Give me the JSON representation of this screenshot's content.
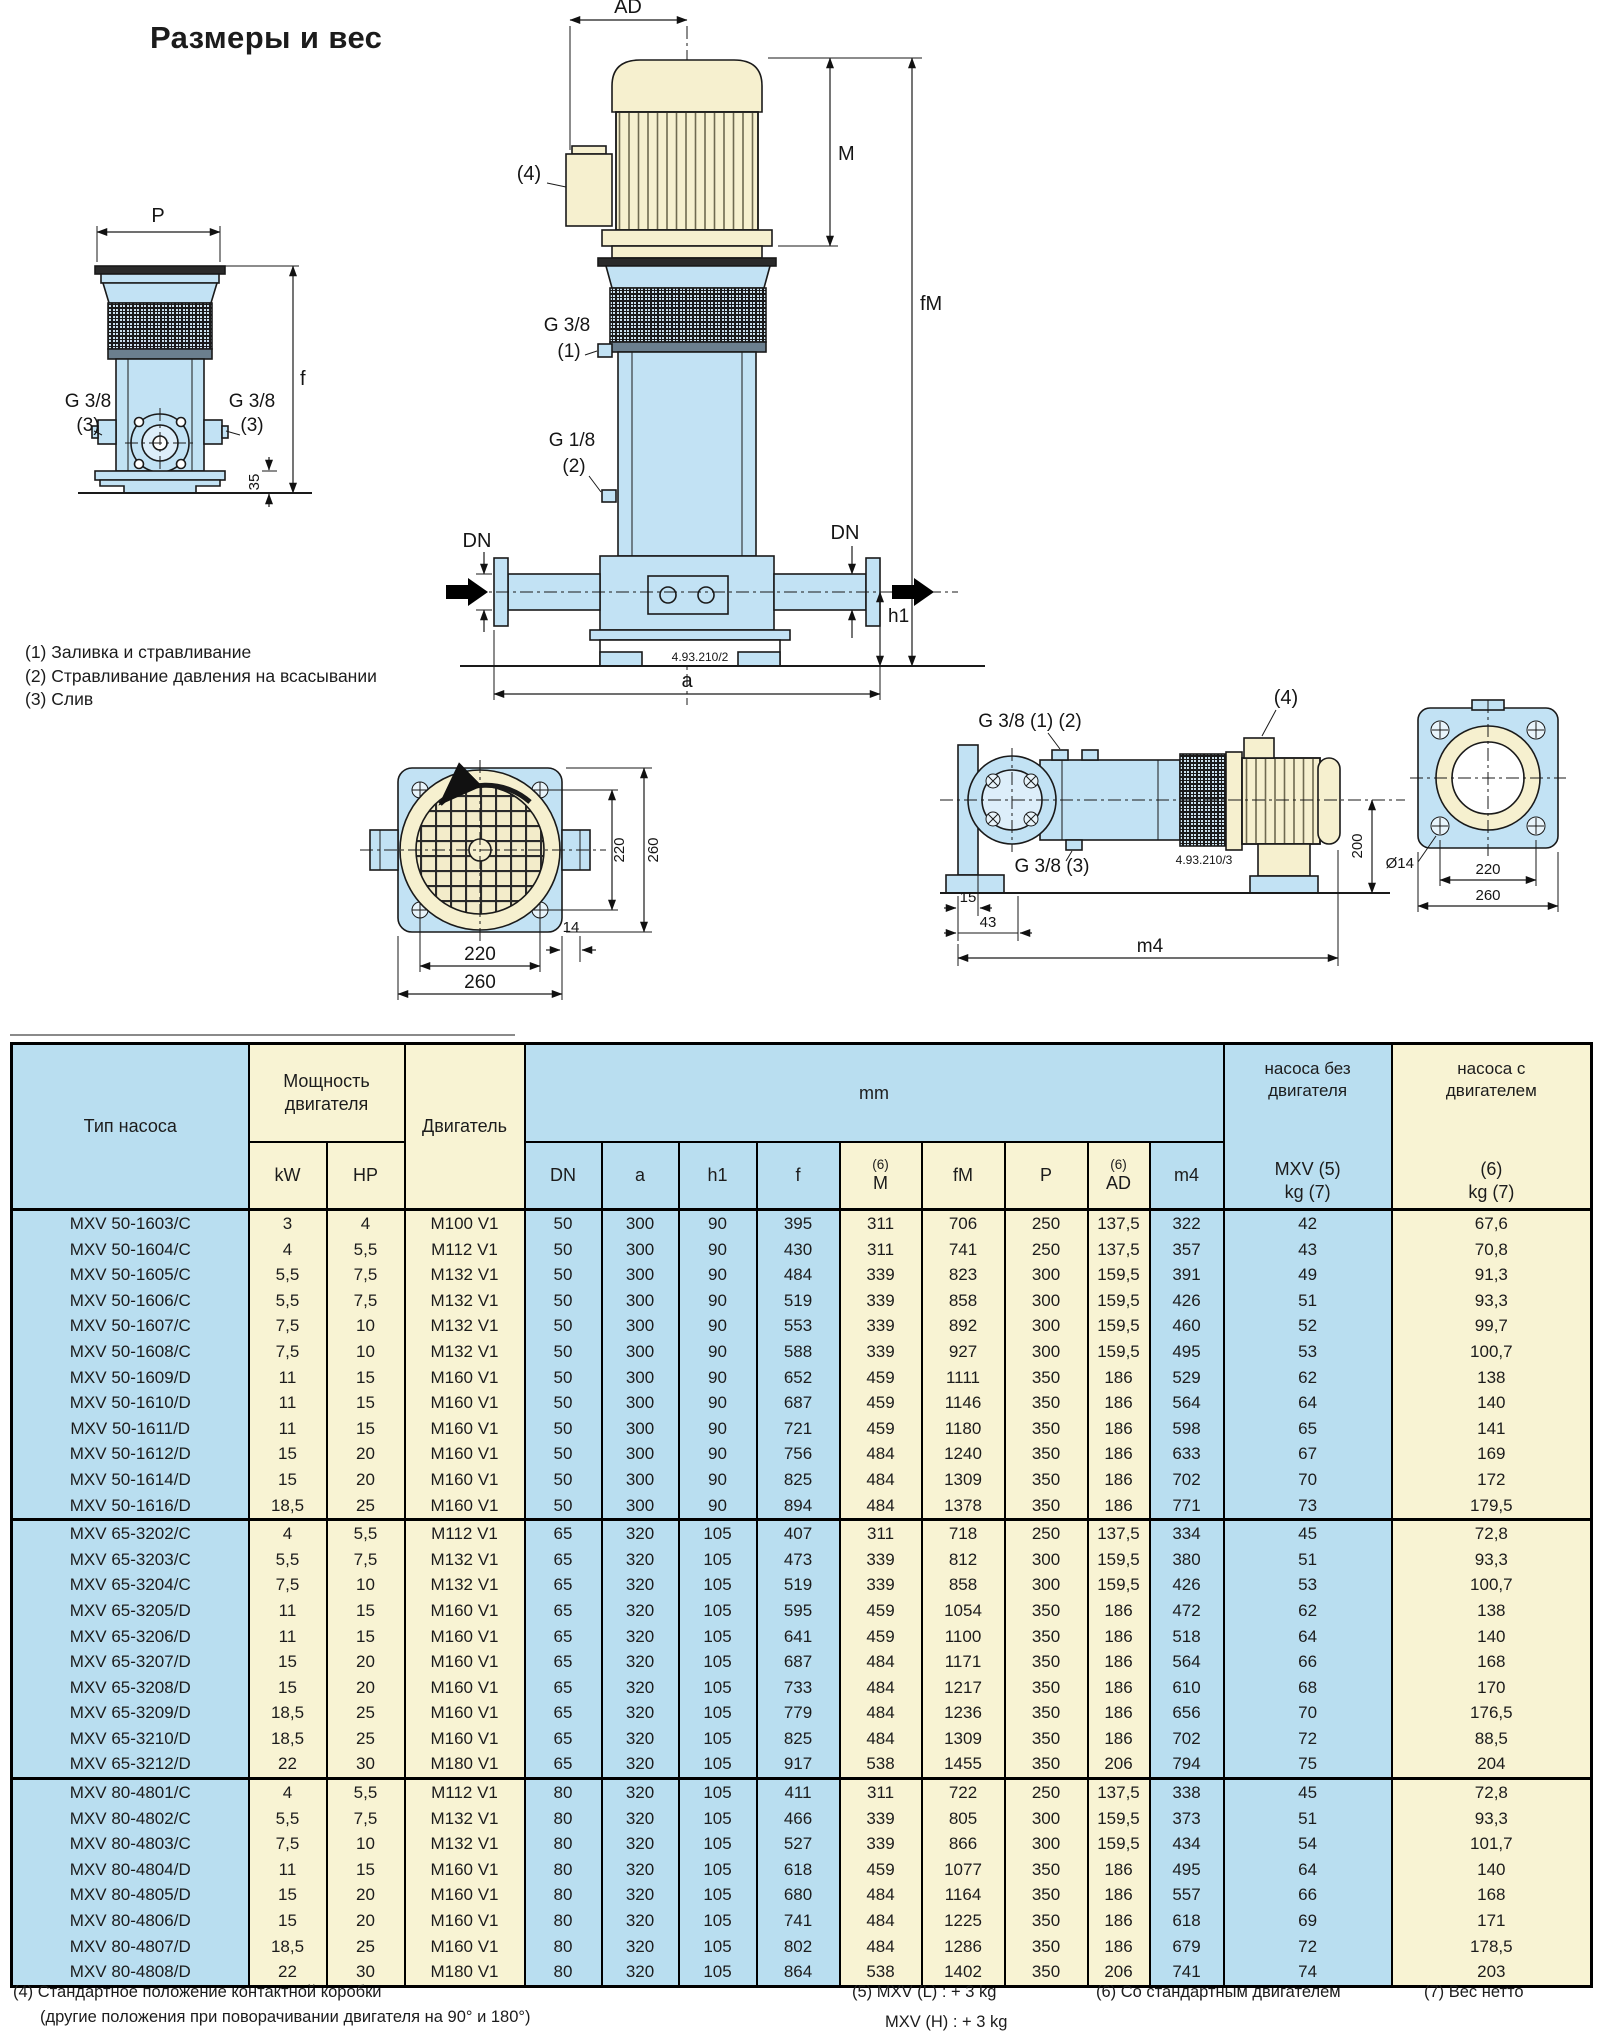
{
  "page": {
    "title": "Размеры и вес",
    "notes": [
      "(1) Заливка и стравливание",
      "(2) Стравливание давления на всасывании",
      "(3) Слив"
    ],
    "footnotes": {
      "f4_line1": "(4) Стандартное положение контактной коробки",
      "f4_line2": "(другие положения при поворачивании двигателя на 90° и 180°)",
      "f5_line1": "(5) MXV (L) : + 3 kg",
      "f5_line2": "MXV (H) : + 3 kg",
      "f6": "(6) Со стандартным двигателем",
      "f7": "(7) Вес нетто"
    }
  },
  "colors": {
    "table_blue": "#b9def0",
    "table_yellow": "#f8f3d3",
    "pump_blue": "#c2e2f4",
    "motor_cream": "#f6f0cf"
  },
  "drawings": {
    "left_view": {
      "dim_p": "P",
      "dim_f": "f",
      "dim_35": "35",
      "g38_left_l1": "G 3/8",
      "g38_left_l2": "(3)",
      "g38_right_l1": "G 3/8",
      "g38_right_l2": "(3)"
    },
    "center_view": {
      "dim_ad": "AD",
      "ref4": "(4)",
      "dim_m": "M",
      "dim_fm": "fM",
      "g38_l1": "G 3/8",
      "g38_l2": "(1)",
      "g18_l1": "G 1/8",
      "g18_l2": "(2)",
      "dn_left": "DN",
      "dn_right": "DN",
      "dim_h1": "h1",
      "dim_a": "a",
      "code": "4.93.210/2"
    },
    "top_view": {
      "dim_220_v": "220",
      "dim_260_v": "260",
      "dim_14": "14",
      "dim_220_h": "220",
      "dim_260_h": "260"
    },
    "side_view": {
      "g38_12": "G 3/8 (1) (2)",
      "g38_3": "G 3/8 (3)",
      "ref4": "(4)",
      "dim_15": "15",
      "dim_43": "43",
      "dim_m4": "m4",
      "dim_200": "200",
      "dim_d14": "Ø14",
      "dim_220": "220",
      "dim_260": "260",
      "code": "4.93.210/3"
    }
  },
  "table": {
    "headers": {
      "type": "Тип насоса",
      "power_l1": "Мощность",
      "power_l2": "двигателя",
      "motor": "Двигатель",
      "mm": "mm",
      "kw": "kW",
      "hp": "HP",
      "dn": "DN",
      "a": "a",
      "h1": "h1",
      "f": "f",
      "m_sup": "(6)",
      "m": "M",
      "fm": "fM",
      "p": "P",
      "ad_sup": "(6)",
      "ad": "AD",
      "m4": "m4",
      "wnm_l1": "насоса без",
      "wnm_l2": "двигателя",
      "wnm_l3": "MXV (5)",
      "wnm_l4": "kg (7)",
      "wwm_l1": "насоса с",
      "wwm_l2": "двигателем",
      "wwm_l3": "(6)",
      "wwm_l4": "kg (7)"
    },
    "sections": [
      [
        [
          "MXV 50-1603/C",
          "3",
          "4",
          "M100 V1",
          "50",
          "300",
          "90",
          "395",
          "311",
          "706",
          "250",
          "137,5",
          "322",
          "42",
          "67,6"
        ],
        [
          "MXV 50-1604/C",
          "4",
          "5,5",
          "M112 V1",
          "50",
          "300",
          "90",
          "430",
          "311",
          "741",
          "250",
          "137,5",
          "357",
          "43",
          "70,8"
        ],
        [
          "MXV 50-1605/C",
          "5,5",
          "7,5",
          "M132 V1",
          "50",
          "300",
          "90",
          "484",
          "339",
          "823",
          "300",
          "159,5",
          "391",
          "49",
          "91,3"
        ],
        [
          "MXV 50-1606/C",
          "5,5",
          "7,5",
          "M132 V1",
          "50",
          "300",
          "90",
          "519",
          "339",
          "858",
          "300",
          "159,5",
          "426",
          "51",
          "93,3"
        ],
        [
          "MXV 50-1607/C",
          "7,5",
          "10",
          "M132 V1",
          "50",
          "300",
          "90",
          "553",
          "339",
          "892",
          "300",
          "159,5",
          "460",
          "52",
          "99,7"
        ],
        [
          "MXV 50-1608/C",
          "7,5",
          "10",
          "M132 V1",
          "50",
          "300",
          "90",
          "588",
          "339",
          "927",
          "300",
          "159,5",
          "495",
          "53",
          "100,7"
        ],
        [
          "MXV 50-1609/D",
          "11",
          "15",
          "M160 V1",
          "50",
          "300",
          "90",
          "652",
          "459",
          "1111",
          "350",
          "186",
          "529",
          "62",
          "138"
        ],
        [
          "MXV 50-1610/D",
          "11",
          "15",
          "M160 V1",
          "50",
          "300",
          "90",
          "687",
          "459",
          "1146",
          "350",
          "186",
          "564",
          "64",
          "140"
        ],
        [
          "MXV 50-1611/D",
          "11",
          "15",
          "M160 V1",
          "50",
          "300",
          "90",
          "721",
          "459",
          "1180",
          "350",
          "186",
          "598",
          "65",
          "141"
        ],
        [
          "MXV 50-1612/D",
          "15",
          "20",
          "M160 V1",
          "50",
          "300",
          "90",
          "756",
          "484",
          "1240",
          "350",
          "186",
          "633",
          "67",
          "169"
        ],
        [
          "MXV 50-1614/D",
          "15",
          "20",
          "M160 V1",
          "50",
          "300",
          "90",
          "825",
          "484",
          "1309",
          "350",
          "186",
          "702",
          "70",
          "172"
        ],
        [
          "MXV 50-1616/D",
          "18,5",
          "25",
          "M160 V1",
          "50",
          "300",
          "90",
          "894",
          "484",
          "1378",
          "350",
          "186",
          "771",
          "73",
          "179,5"
        ]
      ],
      [
        [
          "MXV 65-3202/C",
          "4",
          "5,5",
          "M112 V1",
          "65",
          "320",
          "105",
          "407",
          "311",
          "718",
          "250",
          "137,5",
          "334",
          "45",
          "72,8"
        ],
        [
          "MXV 65-3203/C",
          "5,5",
          "7,5",
          "M132 V1",
          "65",
          "320",
          "105",
          "473",
          "339",
          "812",
          "300",
          "159,5",
          "380",
          "51",
          "93,3"
        ],
        [
          "MXV 65-3204/C",
          "7,5",
          "10",
          "M132 V1",
          "65",
          "320",
          "105",
          "519",
          "339",
          "858",
          "300",
          "159,5",
          "426",
          "53",
          "100,7"
        ],
        [
          "MXV 65-3205/D",
          "11",
          "15",
          "M160 V1",
          "65",
          "320",
          "105",
          "595",
          "459",
          "1054",
          "350",
          "186",
          "472",
          "62",
          "138"
        ],
        [
          "MXV 65-3206/D",
          "11",
          "15",
          "M160 V1",
          "65",
          "320",
          "105",
          "641",
          "459",
          "1100",
          "350",
          "186",
          "518",
          "64",
          "140"
        ],
        [
          "MXV 65-3207/D",
          "15",
          "20",
          "M160 V1",
          "65",
          "320",
          "105",
          "687",
          "484",
          "1171",
          "350",
          "186",
          "564",
          "66",
          "168"
        ],
        [
          "MXV 65-3208/D",
          "15",
          "20",
          "M160 V1",
          "65",
          "320",
          "105",
          "733",
          "484",
          "1217",
          "350",
          "186",
          "610",
          "68",
          "170"
        ],
        [
          "MXV 65-3209/D",
          "18,5",
          "25",
          "M160 V1",
          "65",
          "320",
          "105",
          "779",
          "484",
          "1236",
          "350",
          "186",
          "656",
          "70",
          "176,5"
        ],
        [
          "MXV 65-3210/D",
          "18,5",
          "25",
          "M160 V1",
          "65",
          "320",
          "105",
          "825",
          "484",
          "1309",
          "350",
          "186",
          "702",
          "72",
          "88,5"
        ],
        [
          "MXV 65-3212/D",
          "22",
          "30",
          "M180 V1",
          "65",
          "320",
          "105",
          "917",
          "538",
          "1455",
          "350",
          "206",
          "794",
          "75",
          "204"
        ]
      ],
      [
        [
          "MXV 80-4801/C",
          "4",
          "5,5",
          "M112 V1",
          "80",
          "320",
          "105",
          "411",
          "311",
          "722",
          "250",
          "137,5",
          "338",
          "45",
          "72,8"
        ],
        [
          "MXV 80-4802/C",
          "5,5",
          "7,5",
          "M132 V1",
          "80",
          "320",
          "105",
          "466",
          "339",
          "805",
          "300",
          "159,5",
          "373",
          "51",
          "93,3"
        ],
        [
          "MXV 80-4803/C",
          "7,5",
          "10",
          "M132 V1",
          "80",
          "320",
          "105",
          "527",
          "339",
          "866",
          "300",
          "159,5",
          "434",
          "54",
          "101,7"
        ],
        [
          "MXV 80-4804/D",
          "11",
          "15",
          "M160 V1",
          "80",
          "320",
          "105",
          "618",
          "459",
          "1077",
          "350",
          "186",
          "495",
          "64",
          "140"
        ],
        [
          "MXV 80-4805/D",
          "15",
          "20",
          "M160 V1",
          "80",
          "320",
          "105",
          "680",
          "484",
          "1164",
          "350",
          "186",
          "557",
          "66",
          "168"
        ],
        [
          "MXV 80-4806/D",
          "15",
          "20",
          "M160 V1",
          "80",
          "320",
          "105",
          "741",
          "484",
          "1225",
          "350",
          "186",
          "618",
          "69",
          "171"
        ],
        [
          "MXV 80-4807/D",
          "18,5",
          "25",
          "M160 V1",
          "80",
          "320",
          "105",
          "802",
          "484",
          "1286",
          "350",
          "186",
          "679",
          "72",
          "178,5"
        ],
        [
          "MXV 80-4808/D",
          "22",
          "30",
          "M180 V1",
          "80",
          "320",
          "105",
          "864",
          "538",
          "1402",
          "350",
          "206",
          "741",
          "74",
          "203"
        ]
      ]
    ]
  }
}
